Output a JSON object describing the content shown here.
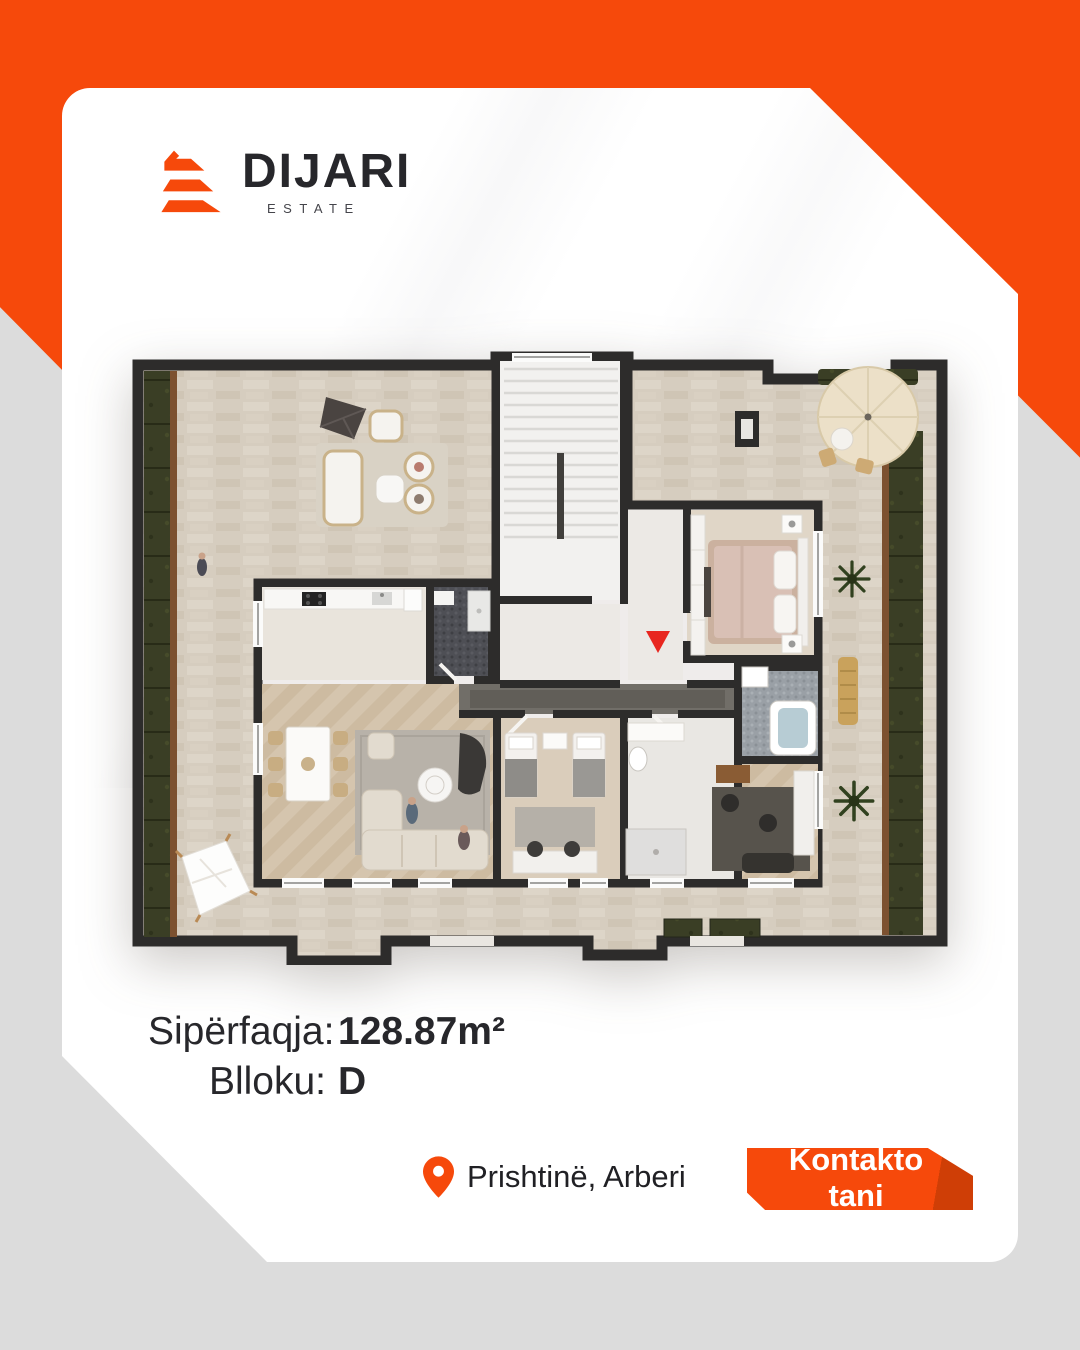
{
  "brand": {
    "name": "DIJARI",
    "tagline": "ESTATE"
  },
  "details": {
    "area_label": "Sipërfaqja:",
    "area_value": "128.87m²",
    "block_label": "Blloku:",
    "block_value": "D"
  },
  "location": {
    "text": "Prishtinë, Arberi"
  },
  "cta": {
    "label": "Kontakto tani"
  },
  "colors": {
    "brand_orange": "#F6490B",
    "orange_dark": "#CF3E06",
    "background_gray": "#DCDCDC",
    "card_white": "#FFFFFF",
    "text_dark": "#27272B",
    "wall_dark": "#2D2C2B",
    "terrace_stone": "#D6CDBF",
    "hedge_green": "#3A3E25",
    "entrance_marker_red": "#E8261F"
  },
  "floor_plan": {
    "view": "3d-top-down-apartment-plan",
    "features": [
      "wrap-around terrace",
      "hedges",
      "staircase",
      "entrance-marker",
      "master-bedroom",
      "kids-bedroom",
      "kitchen",
      "dining",
      "living-room",
      "bathrooms",
      "office",
      "parasols",
      "palm-plants",
      "shade-sail"
    ]
  }
}
